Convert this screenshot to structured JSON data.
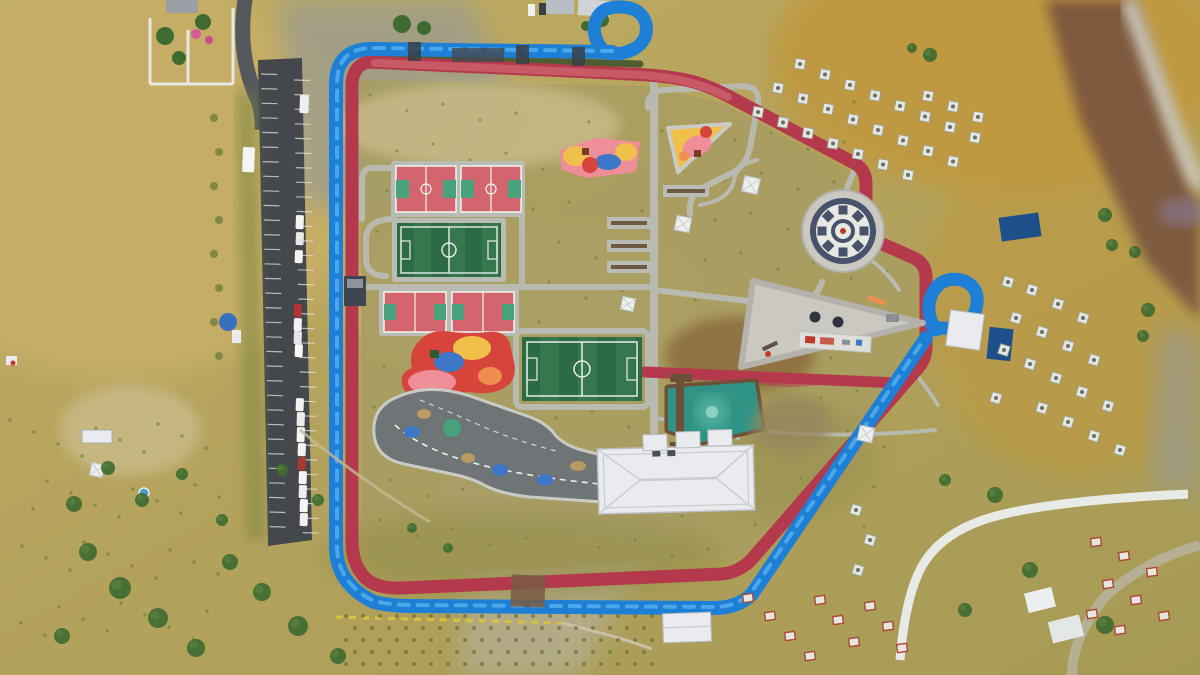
{
  "meta": {
    "title": "Top-down aerial drone photograph of a hillside sports and recreation park",
    "setting": "Arid hillside terrain with terraced tree plantings surrounding a new public park"
  },
  "colors": {
    "terrain": "#b3a25c",
    "terrainLight": "#c7ae66",
    "ochre": "#c0993f",
    "rock": "#9a9b90",
    "brownRock": "#74503c",
    "purpleRock": "#8a7a9a",
    "parkInterior": "#a89c62",
    "dirtPale": "#cabc8a",
    "brownPatch": "#8c6c3e",
    "oliveBand": "#98914f",
    "creek": "#b5ad93",
    "trackBlue": "#1e7fd6",
    "trackBlueHi": "#58b2ec",
    "trackRed": "#b5394c",
    "trackRedHi": "#c85a66",
    "median": "#4f5e30",
    "walkway": "#b9bcb4",
    "asphalt": "#44484c",
    "roadGray": "#55585c",
    "courtRed": "#d2656e",
    "courtKey": "#48a37c",
    "pitch": "#2c6b44",
    "pitchStripe": "#35784e",
    "lineWhite": "#f2f4f0",
    "pondTeal": "#2f9486",
    "pondCore": "#5ab3a2",
    "deckBrown": "#6e4f38",
    "roofWhite": "#e9ebee",
    "roofShade": "#c9ccd0",
    "plaza": "#cac8c1",
    "plazaRing": "#46536b",
    "playYellow": "#f0c04a",
    "playPink": "#ee8e99",
    "playRed": "#d6443c",
    "playBlue": "#3f77c8",
    "playOrange": "#ef8f4e",
    "tree": "#3f6b31",
    "bush": "#74813f",
    "planter": "#e4e6e0",
    "tableRed": "#a84a38",
    "wallWhite": "#e8eae6",
    "yellowDash": "#d9c23e",
    "kioskBlue": "#3a6fc0",
    "containerBlue": "#1d4f8a",
    "trafficAsphalt": "#6f7477"
  },
  "scene": {
    "facilities": [
      {
        "id": "cycling-track",
        "label": "Blue bicycle track with two teardrop turnarounds"
      },
      {
        "id": "running-track",
        "label": "Red jogging track loop around the park"
      },
      {
        "id": "basketball-courts-upper",
        "label": "Two basketball courts"
      },
      {
        "id": "basketball-courts-lower",
        "label": "Two basketball courts"
      },
      {
        "id": "mini-football-field-west",
        "label": "Mini artificial turf football field"
      },
      {
        "id": "mini-football-field-center",
        "label": "Mini artificial turf football field"
      },
      {
        "id": "playground-west",
        "label": "Colorful children's playground"
      },
      {
        "id": "playground-north",
        "label": "Colorful children's playground"
      },
      {
        "id": "playground-northeast",
        "label": "Triangular children's playground"
      },
      {
        "id": "traffic-training-track",
        "label": "Children's traffic training circuit"
      },
      {
        "id": "event-building",
        "label": "White hip-roofed multi-purpose building"
      },
      {
        "id": "pond",
        "label": "Green ornamental pond with wooden pier"
      },
      {
        "id": "mosaic-plaza",
        "label": "Circular mosaic plaza"
      },
      {
        "id": "triangle-plaza",
        "label": "Triangular activity plaza"
      },
      {
        "id": "pergola-walkway",
        "label": "Central pergola walkway with seating bays"
      },
      {
        "id": "parking-lot",
        "label": "Roadside parking lot with parked vehicles"
      },
      {
        "id": "tree-planters",
        "label": "Grids of square tree planters on the slope"
      }
    ]
  },
  "counts": {
    "basketball_courts": 4,
    "football_fields": 2,
    "playgrounds": 3,
    "white_gazebos": 6,
    "parked_vehicles": 18,
    "teardrop_loops": 2
  }
}
